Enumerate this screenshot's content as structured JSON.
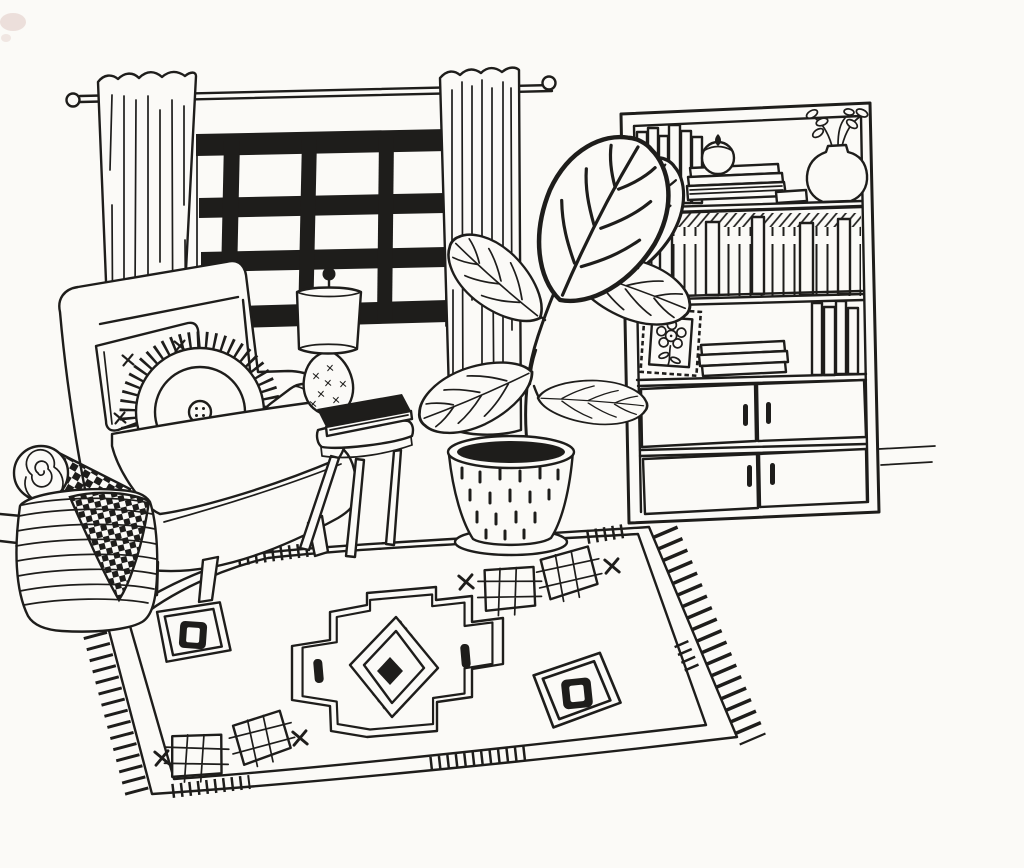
{
  "meta": {
    "title": "Hand-drawn living room illustration",
    "width_px": 1024,
    "height_px": 868
  },
  "style": {
    "ink_color": "#1e1d1b",
    "paper_color": "#fbfaf7",
    "smudge_color": "#e9d8d3"
  },
  "scene": {
    "description": "Black ink line drawing of a cozy living room: a paned window with two curtains on a rod, a bookcase with books, a lidded jar, a vase of branches, a stamp-framed flower picture and four cabinet doors, an armchair with a cross-stitched square pillow and a round fringed button pillow, a three-legged stool side table holding a lamp and a black book, a potted fiddle-leaf fig on a saucer, a striped basket holding a rolled checkered blanket and a draped checkered cloth, all on a large fringed rug with a stepped diamond medallion and diamond motifs."
  },
  "objects": {
    "window": {
      "label": "paned window",
      "pane_columns": 4,
      "pane_rows": 4
    },
    "curtain_rod": {
      "label": "curtain rod with round finials"
    },
    "curtains": {
      "label": "left and right curtain panels"
    },
    "bookshelf": {
      "label": "bookcase with lower cabinet",
      "top_shelf": [
        "standing books",
        "lidded jar on stack of books",
        "vase with leafy branches"
      ],
      "middle_shelf": [
        "full row of book spines"
      ],
      "third_shelf": [
        "stamp-edged framed flower picture",
        "stack of books",
        "standing books"
      ],
      "cabinet_door_count": 4
    },
    "armchair": {
      "label": "armchair",
      "pillows": [
        "square pillow with stitch crosses",
        "round fringed pillow with center button"
      ],
      "bolster": "arm bolster cushion"
    },
    "side_table": {
      "label": "three-legged stool side table"
    },
    "lamp": {
      "label": "lamp with drum shade, ball finial and patterned gourd base"
    },
    "book_on_table": {
      "label": "black book"
    },
    "plant": {
      "label": "fiddle-leaf fig plant",
      "leaf_count": 6,
      "pot": "speckled tapered pot with black soil on saucer"
    },
    "rug": {
      "label": "fringed area rug",
      "motifs": [
        "stepped diamond medallion with hatched inner diamond and black center",
        "pair of grid diamonds top",
        "pair of grid diamonds bottom",
        "framed diamond left",
        "framed diamond right",
        "x stitch marks",
        "small black bars"
      ]
    },
    "basket": {
      "label": "striped woven basket",
      "contents": [
        "rolled checkered blanket with spiral end",
        "draped checkered cloth"
      ]
    },
    "floor": {
      "label": "floor lines and baseboard"
    }
  }
}
